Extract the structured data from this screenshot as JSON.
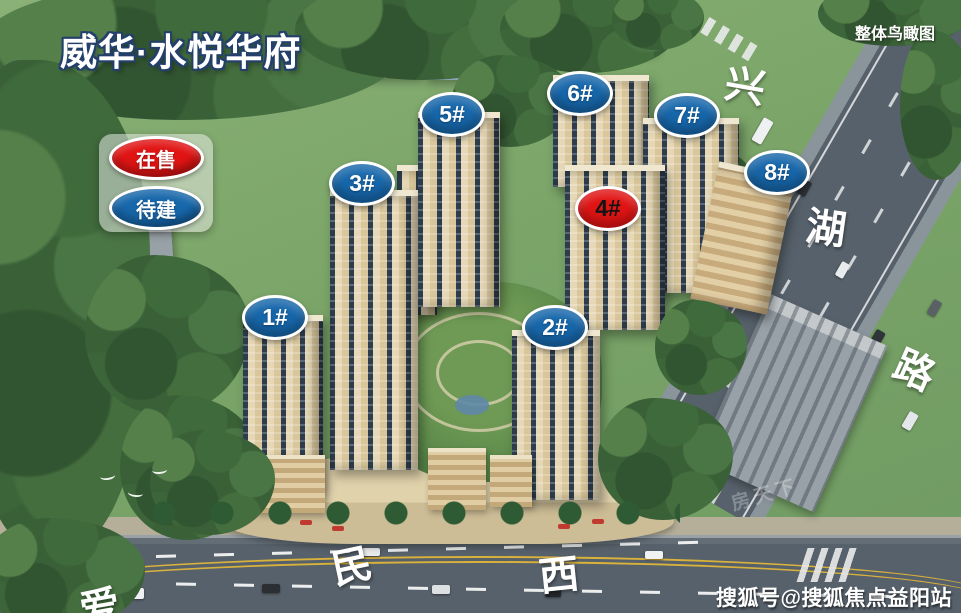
{
  "title": "威华·水悦华府",
  "corner_caption": "整体鸟瞰图",
  "legend": {
    "items": [
      {
        "label": "在售",
        "status": "onsale",
        "color": "#e11414"
      },
      {
        "label": "待建",
        "status": "planned",
        "color": "#1767ab"
      }
    ]
  },
  "buildings": [
    {
      "label": "1#",
      "status": "planned",
      "x": 275,
      "y": 317
    },
    {
      "label": "2#",
      "status": "planned",
      "x": 555,
      "y": 327
    },
    {
      "label": "3#",
      "status": "planned",
      "x": 362,
      "y": 183
    },
    {
      "label": "4#",
      "status": "onsale",
      "x": 608,
      "y": 208
    },
    {
      "label": "5#",
      "status": "planned",
      "x": 452,
      "y": 114
    },
    {
      "label": "6#",
      "status": "planned",
      "x": 580,
      "y": 93
    },
    {
      "label": "7#",
      "status": "planned",
      "x": 687,
      "y": 115
    },
    {
      "label": "8#",
      "status": "planned",
      "x": 777,
      "y": 172
    }
  ],
  "road_labels": [
    {
      "char": "兴",
      "x": 745,
      "y": 87,
      "rotate": 10
    },
    {
      "char": "湖",
      "x": 826,
      "y": 229,
      "rotate": 8
    },
    {
      "char": "路",
      "x": 914,
      "y": 371,
      "rotate": 24
    },
    {
      "char": "民",
      "x": 352,
      "y": 567,
      "rotate": -12
    },
    {
      "char": "西",
      "x": 559,
      "y": 576,
      "rotate": -6
    },
    {
      "char": "爱",
      "x": 100,
      "y": 608,
      "rotate": -10
    }
  ],
  "watermarks": {
    "sohu": "搜狐号@搜狐焦点益阳站",
    "faint": "房天下"
  },
  "colors": {
    "marker_blue": "#1767ab",
    "marker_red": "#e11414",
    "marker_border": "#ffffff"
  }
}
